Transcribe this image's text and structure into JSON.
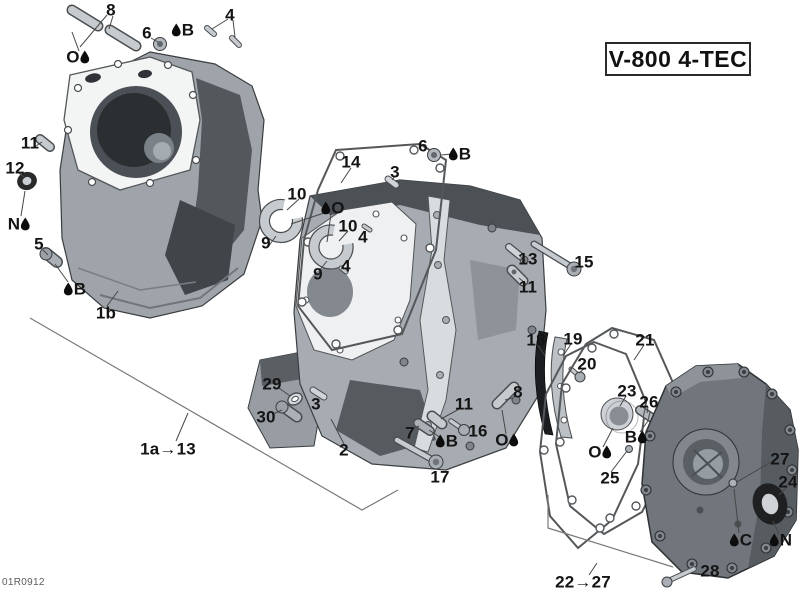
{
  "page": {
    "title_plate": "V-800 4-TEC",
    "doc_code": "01R0912"
  },
  "colors": {
    "leader_line": "#474747",
    "bracket_line": "#7a7a7a",
    "label_text": "#141414",
    "droplet": "#0d0d0d"
  },
  "diagram": {
    "callouts": [
      {
        "label": "8",
        "x": 111,
        "y": 10,
        "droplet": "none"
      },
      {
        "label": "O",
        "x": 78,
        "y": 57,
        "droplet": "right"
      },
      {
        "label": "6",
        "x": 147,
        "y": 33,
        "droplet": "none"
      },
      {
        "label": "B",
        "x": 183,
        "y": 30,
        "droplet": "left"
      },
      {
        "label": "4",
        "x": 230,
        "y": 15,
        "droplet": "none"
      },
      {
        "label": "11",
        "x": 30,
        "y": 143,
        "droplet": "none"
      },
      {
        "label": "12",
        "x": 15,
        "y": 168,
        "droplet": "none"
      },
      {
        "label": "N",
        "x": 19,
        "y": 224,
        "droplet": "right"
      },
      {
        "label": "5",
        "x": 39,
        "y": 244,
        "droplet": "none"
      },
      {
        "label": "B",
        "x": 75,
        "y": 289,
        "droplet": "left"
      },
      {
        "label": "1b",
        "x": 106,
        "y": 313,
        "droplet": "none"
      },
      {
        "label": "14",
        "x": 351,
        "y": 162,
        "droplet": "none"
      },
      {
        "label": "3",
        "x": 395,
        "y": 172,
        "droplet": "none"
      },
      {
        "label": "6",
        "x": 423,
        "y": 146,
        "droplet": "none"
      },
      {
        "label": "B",
        "x": 460,
        "y": 154,
        "droplet": "left"
      },
      {
        "label": "10",
        "x": 297,
        "y": 194,
        "droplet": "none"
      },
      {
        "label": "O",
        "x": 333,
        "y": 208,
        "droplet": "left"
      },
      {
        "label": "10",
        "x": 348,
        "y": 226,
        "droplet": "none"
      },
      {
        "label": "4",
        "x": 363,
        "y": 237,
        "droplet": "none"
      },
      {
        "label": "9",
        "x": 266,
        "y": 243,
        "droplet": "none"
      },
      {
        "label": "4",
        "x": 346,
        "y": 266,
        "droplet": "none"
      },
      {
        "label": "9",
        "x": 318,
        "y": 274,
        "droplet": "none"
      },
      {
        "label": "13",
        "x": 528,
        "y": 259,
        "droplet": "none"
      },
      {
        "label": "15",
        "x": 584,
        "y": 262,
        "droplet": "none"
      },
      {
        "label": "11",
        "x": 528,
        "y": 287,
        "droplet": "none"
      },
      {
        "label": "18",
        "x": 536,
        "y": 340,
        "droplet": "none"
      },
      {
        "label": "19",
        "x": 573,
        "y": 339,
        "droplet": "none"
      },
      {
        "label": "20",
        "x": 587,
        "y": 364,
        "droplet": "none"
      },
      {
        "label": "21",
        "x": 645,
        "y": 340,
        "droplet": "none"
      },
      {
        "label": "23",
        "x": 627,
        "y": 391,
        "droplet": "none"
      },
      {
        "label": "26",
        "x": 649,
        "y": 402,
        "droplet": "none"
      },
      {
        "label": "B",
        "x": 636,
        "y": 437,
        "droplet": "right"
      },
      {
        "label": "O",
        "x": 600,
        "y": 452,
        "droplet": "right"
      },
      {
        "label": "25",
        "x": 610,
        "y": 478,
        "droplet": "none"
      },
      {
        "label": "27",
        "x": 780,
        "y": 459,
        "droplet": "none"
      },
      {
        "label": "24",
        "x": 788,
        "y": 482,
        "droplet": "none"
      },
      {
        "label": "C",
        "x": 741,
        "y": 540,
        "droplet": "left"
      },
      {
        "label": "N",
        "x": 781,
        "y": 540,
        "droplet": "left"
      },
      {
        "label": "28",
        "x": 710,
        "y": 571,
        "droplet": "none"
      },
      {
        "label": "22→27",
        "x": 583,
        "y": 582,
        "droplet": "none",
        "group": true
      },
      {
        "label": "1a→13",
        "x": 168,
        "y": 449,
        "droplet": "none",
        "group": true
      },
      {
        "label": "29",
        "x": 272,
        "y": 384,
        "droplet": "none"
      },
      {
        "label": "30",
        "x": 266,
        "y": 417,
        "droplet": "none"
      },
      {
        "label": "3",
        "x": 316,
        "y": 404,
        "droplet": "none"
      },
      {
        "label": "2",
        "x": 344,
        "y": 450,
        "droplet": "none"
      },
      {
        "label": "7",
        "x": 410,
        "y": 433,
        "droplet": "none"
      },
      {
        "label": "B",
        "x": 447,
        "y": 441,
        "droplet": "left"
      },
      {
        "label": "17",
        "x": 440,
        "y": 477,
        "droplet": "none"
      },
      {
        "label": "11",
        "x": 464,
        "y": 404,
        "droplet": "none"
      },
      {
        "label": "16",
        "x": 478,
        "y": 431,
        "droplet": "none"
      },
      {
        "label": "8",
        "x": 518,
        "y": 392,
        "droplet": "none"
      },
      {
        "label": "O",
        "x": 507,
        "y": 440,
        "droplet": "right"
      }
    ],
    "leaders": [
      [
        107,
        15,
        80,
        47
      ],
      [
        113,
        16,
        109,
        29
      ],
      [
        79,
        51,
        72,
        32
      ],
      [
        151,
        38,
        158,
        42
      ],
      [
        228,
        19,
        212,
        29
      ],
      [
        233,
        20,
        235,
        37
      ],
      [
        36,
        146,
        42,
        142
      ],
      [
        19,
        173,
        24,
        177
      ],
      [
        25,
        191,
        21,
        216
      ],
      [
        43,
        250,
        48,
        255
      ],
      [
        55,
        264,
        68,
        282
      ],
      [
        107,
        306,
        118,
        291
      ],
      [
        351,
        168,
        341,
        183
      ],
      [
        395,
        176,
        392,
        180
      ],
      [
        441,
        155,
        452,
        154
      ],
      [
        299,
        199,
        287,
        210
      ],
      [
        327,
        212,
        291,
        224
      ],
      [
        331,
        214,
        327,
        242
      ],
      [
        348,
        231,
        339,
        241
      ],
      [
        268,
        247,
        276,
        236
      ],
      [
        319,
        271,
        327,
        261
      ],
      [
        525,
        261,
        519,
        255
      ],
      [
        526,
        284,
        519,
        278
      ],
      [
        538,
        345,
        545,
        356
      ],
      [
        571,
        344,
        563,
        356
      ],
      [
        585,
        368,
        579,
        373
      ],
      [
        644,
        345,
        634,
        360
      ],
      [
        626,
        396,
        620,
        406
      ],
      [
        648,
        407,
        647,
        413
      ],
      [
        640,
        432,
        648,
        421
      ],
      [
        603,
        447,
        613,
        428
      ],
      [
        611,
        472,
        627,
        451
      ],
      [
        771,
        462,
        737,
        482
      ],
      [
        739,
        533,
        734,
        489
      ],
      [
        787,
        487,
        779,
        495
      ],
      [
        779,
        534,
        773,
        521
      ],
      [
        279,
        388,
        290,
        396
      ],
      [
        273,
        414,
        282,
        410
      ],
      [
        344,
        444,
        331,
        419
      ],
      [
        413,
        429,
        419,
        426
      ],
      [
        429,
        430,
        441,
        438
      ],
      [
        461,
        408,
        441,
        419
      ],
      [
        513,
        398,
        505,
        400
      ],
      [
        506,
        434,
        502,
        410
      ],
      [
        176,
        441,
        188,
        413
      ],
      [
        589,
        575,
        597,
        563
      ]
    ],
    "brackets": [
      {
        "points": "30,318 362,510 398,490"
      },
      {
        "points": "548,495 548,528 673,567"
      }
    ]
  }
}
